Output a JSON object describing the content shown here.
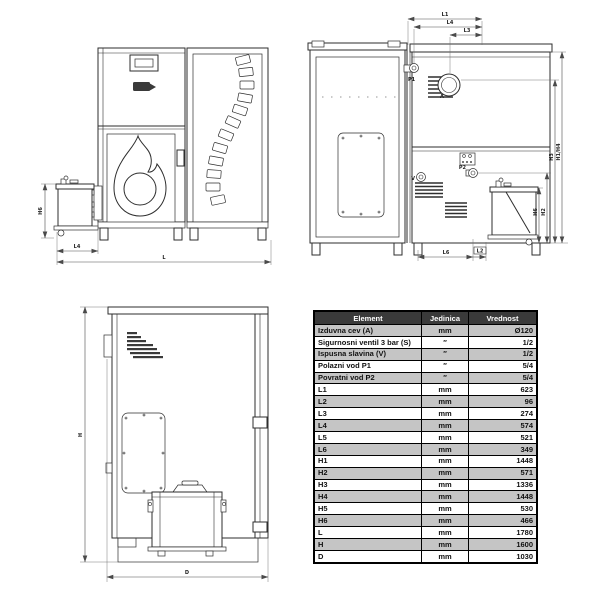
{
  "colors": {
    "line": "#2e2e2e",
    "table_header_bg": "#3a3a3a",
    "table_header_text": "#ffffff",
    "table_row_alt": "#c5c5c5",
    "table_border": "#000000",
    "page_bg": "#ffffff"
  },
  "table": {
    "headers": {
      "element": "Element",
      "unit": "Jedinica",
      "value": "Vrednost"
    },
    "rows": [
      {
        "element": "Izduvna cev (A)",
        "unit": "mm",
        "value": "Ø120"
      },
      {
        "element": "Sigurnosni ventil 3 bar (S)",
        "unit": "″",
        "value": "1/2"
      },
      {
        "element": "Ispusna slavina (V)",
        "unit": "″",
        "value": "1/2"
      },
      {
        "element": "Polazni vod P1",
        "unit": "″",
        "value": "5/4"
      },
      {
        "element": "Povratni vod P2",
        "unit": "″",
        "value": "5/4"
      },
      {
        "element": "L1",
        "unit": "mm",
        "value": "623"
      },
      {
        "element": "L2",
        "unit": "mm",
        "value": "96"
      },
      {
        "element": "L3",
        "unit": "mm",
        "value": "274"
      },
      {
        "element": "L4",
        "unit": "mm",
        "value": "574"
      },
      {
        "element": "L5",
        "unit": "mm",
        "value": "521"
      },
      {
        "element": "L6",
        "unit": "mm",
        "value": "349"
      },
      {
        "element": "H1",
        "unit": "mm",
        "value": "1448"
      },
      {
        "element": "H2",
        "unit": "mm",
        "value": "571"
      },
      {
        "element": "H3",
        "unit": "mm",
        "value": "1336"
      },
      {
        "element": "H4",
        "unit": "mm",
        "value": "1448"
      },
      {
        "element": "H5",
        "unit": "mm",
        "value": "530"
      },
      {
        "element": "H6",
        "unit": "mm",
        "value": "466"
      },
      {
        "element": "L",
        "unit": "mm",
        "value": "1780"
      },
      {
        "element": "H",
        "unit": "mm",
        "value": "1600"
      },
      {
        "element": "D",
        "unit": "mm",
        "value": "1030"
      }
    ]
  },
  "labels": {
    "front": {
      "h6": "H6",
      "l4": "L4",
      "l": "L"
    },
    "rear": {
      "l1": "L1",
      "l4": "L4",
      "l3": "L3",
      "h1_h4": "H1/H4",
      "h3": "H3",
      "h2": "H2",
      "h6": "H6",
      "l6": "L6",
      "l2": "L2",
      "p1": "P1",
      "a": "A",
      "v": "V",
      "p2": "P2"
    },
    "side": {
      "h": "H",
      "d": "D"
    }
  }
}
